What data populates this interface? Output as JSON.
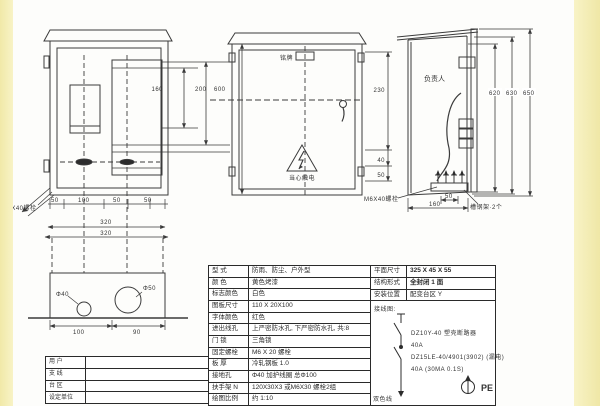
{
  "page": {
    "strip_color": "#f5efbc",
    "line_color": "#3b3b3b"
  },
  "annotations": {
    "left_view": {
      "bolt_label": "M6X40螺栓",
      "small_dims": [
        "50",
        "100",
        "50",
        "50"
      ],
      "dim_width_inner": "320",
      "dim_width_outer": "320",
      "dim_160": "160",
      "dim_200": "200",
      "dim_600": "600"
    },
    "front_view": {
      "nameplate_label": "铭牌",
      "warning_text": "当心触电",
      "dim_230": "230",
      "dim_40": "40",
      "dim_50": "50"
    },
    "side_view": {
      "person_label": "负责人",
      "dim_620": "620",
      "dim_630": "630",
      "dim_650": "650",
      "dim_50": "50",
      "dim_160": "160",
      "bolt_label": "M6X40螺栓",
      "note": "槽钢架·2个"
    },
    "bottom_view": {
      "hole_small": "Φ40",
      "hole_large": "Φ50",
      "dim_100": "100",
      "dim_90": "90"
    }
  },
  "user_table": {
    "rows": [
      {
        "label": "用 户",
        "value": ""
      },
      {
        "label": "支 线",
        "value": ""
      },
      {
        "label": "台 区",
        "value": ""
      },
      {
        "label": "设定单位",
        "value": ""
      }
    ]
  },
  "spec_table": {
    "left_rows": [
      {
        "label": "型  式",
        "value": "防雨、防尘、户外型"
      },
      {
        "label": "颜  色",
        "value": "黄色烤漆"
      },
      {
        "label": "标志颜色",
        "value": "白色"
      },
      {
        "label": "图板尺寸",
        "value": "110 X 20X100"
      },
      {
        "label": "字体颜色",
        "value": "红色"
      },
      {
        "label": "进出线孔",
        "value": "上严密防水孔, 下严密防水孔, 共:8"
      },
      {
        "label": "门  锁",
        "value": "三角锁"
      },
      {
        "label": "固定螺栓",
        "value": "M6 X 20 螺栓"
      },
      {
        "label": "板  厚",
        "value": "冷轧钢板 1.0"
      },
      {
        "label": "接地孔",
        "value": "Φ40 加护线圈 总Φ100"
      },
      {
        "label": "扶手架 N",
        "value": "120X30X3 或M6X30 螺栓2组"
      },
      {
        "label": "绘图比例",
        "value": "约 1:10"
      }
    ],
    "right_rows": [
      {
        "label": "平面尺寸",
        "value": "325 X 45 X 55"
      },
      {
        "label": "结构形式",
        "value": "全封闭 1 面"
      },
      {
        "label": "安装位置",
        "value": "配变台区 Y"
      }
    ],
    "wiring": {
      "heading": "接线图:",
      "breaker1_model": "DZ10Y-40 塑壳断路器",
      "breaker1_rating": "40A",
      "breaker2_model": "DZ15LE-40/4901(3902) (漏电)",
      "breaker2_rating": "40A (30MA 0.1S)",
      "wire_label": "双色线",
      "pe_label": "PE"
    }
  }
}
